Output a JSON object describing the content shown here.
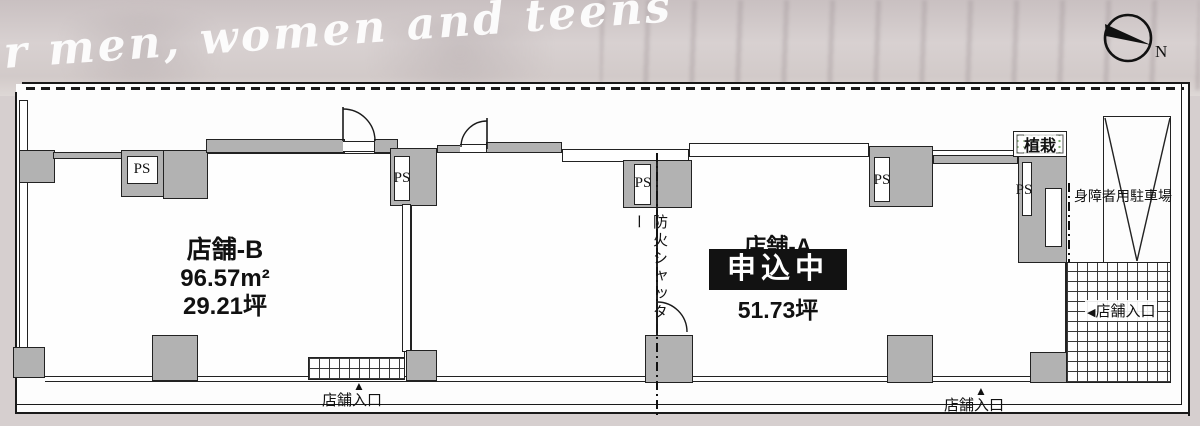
{
  "banner": {
    "script_text": "r men, women and teens"
  },
  "compass": {
    "label": "N"
  },
  "units": {
    "unit_b": {
      "name": "店舗-B",
      "area_m2": "96.57m²",
      "area_tsubo": "29.21坪"
    },
    "unit_a": {
      "name": "店舗-A",
      "status": "申込中",
      "area_tsubo": "51.73坪"
    }
  },
  "labels": {
    "ps": "PS",
    "fire_shutter": "防火シャッター",
    "planting": "植栽",
    "disabled_parking": "身障者用駐車場",
    "entrance": "店舗入口",
    "marker_up": "▲",
    "marker_left": "◀"
  },
  "colors": {
    "wall_gray": "#b2b2b2",
    "line_black": "#1a1a1a",
    "status_bg": "#121212",
    "status_text": "#ffffff"
  }
}
